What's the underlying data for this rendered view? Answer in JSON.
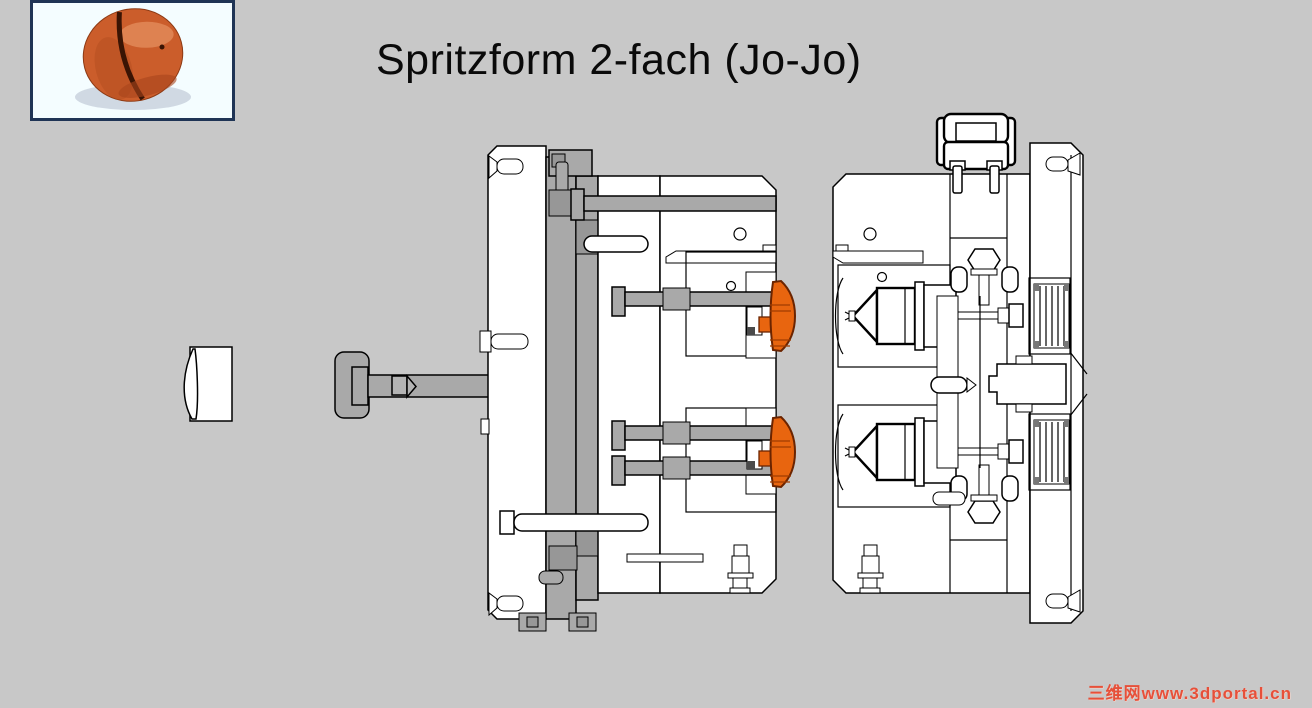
{
  "slide": {
    "title": "Spritzform 2-fach (Jo-Jo)",
    "watermark": "三维网www.3dportal.cn"
  },
  "colors": {
    "background": "#C8C8C8",
    "part_orange": "#E8650F",
    "mechanism_gray": "#A9A9A9",
    "outline_black": "#000000",
    "photo_border_navy": "#1F3455",
    "photo_background": "#F4FDFF",
    "watermark_red": "#E6503A"
  },
  "figure": {
    "photo": "yoyo-product-photo",
    "drawing": "injection-mold-cross-section-two-cavity"
  }
}
